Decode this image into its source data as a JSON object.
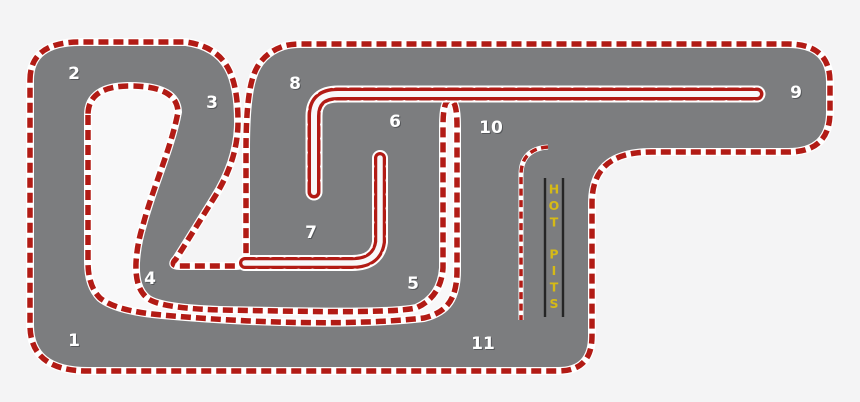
{
  "map": {
    "type": "karting-track-map",
    "corners": [
      {
        "label": "1",
        "x": 74,
        "y": 341
      },
      {
        "label": "2",
        "x": 74,
        "y": 74
      },
      {
        "label": "3",
        "x": 212,
        "y": 103
      },
      {
        "label": "4",
        "x": 150,
        "y": 279
      },
      {
        "label": "5",
        "x": 413,
        "y": 284
      },
      {
        "label": "6",
        "x": 395,
        "y": 122
      },
      {
        "label": "7",
        "x": 311,
        "y": 233
      },
      {
        "label": "8",
        "x": 295,
        "y": 84
      },
      {
        "label": "9",
        "x": 796,
        "y": 93
      },
      {
        "label": "10",
        "x": 491,
        "y": 128
      },
      {
        "label": "11",
        "x": 483,
        "y": 344
      }
    ],
    "pits": {
      "label": "HOT PITS",
      "word1": "HOT",
      "word2": "PITS"
    },
    "colors": {
      "background": "#f4f4f5",
      "infield": "#f8f8f9",
      "track_surface": "#7c7d7f",
      "curb_red": "#b21b15",
      "curb_white": "#ffffff",
      "pit_text_yellow": "#d6ba16",
      "pit_bar_black": "#252525",
      "corner_number": "#ffffff",
      "corner_number_shadow": "#55575a"
    }
  }
}
